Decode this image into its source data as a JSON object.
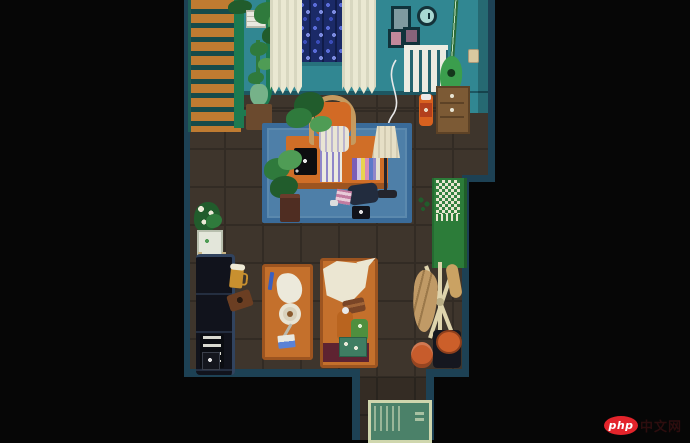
{
  "watermark": {
    "brand": "php",
    "suffix": "中文网"
  },
  "palette": {
    "bg": "#060606",
    "wall": "#318792",
    "wall_border": "#1d4154",
    "floor": "#3e352c",
    "floor_line": "#322b24",
    "rug": "#4e7fa8",
    "rug_border": "#3a6b99",
    "desk": "#d06e27",
    "desk_edge": "#9c5420",
    "table": "#c4702c",
    "table_edge": "#9c5420",
    "stairs_step": "#bf7b31",
    "stairs_gap": "#174b4a",
    "stairs_rail": "#1d7a50",
    "curtain": "#eae8d2",
    "window": "#1b2a67",
    "wisteria": "#5a6cd8",
    "plant": "#2f7a3c",
    "plant_dark": "#215c2c",
    "plant_light": "#4f9c55",
    "pot": "#4f2d22",
    "couch": "#11131c",
    "couch_edge": "#31435e",
    "wardrobe": "#2c7c39",
    "towel": "#e9e6d0",
    "towel_check": "#33803f",
    "mat": "#4b8169",
    "mat_border": "#cfd6ad",
    "radiator": "#ecece2",
    "lamp_shade": "#e6dfc6",
    "crate": "#7c5a35",
    "coat_rack": "#ded3ac",
    "coat": "#c09a66",
    "stool_top": "#cc5f2a",
    "pouf": "#c75c2c",
    "clock_face": "#a8d8d2",
    "guitar": "#3b9e4d",
    "maroon": "#5e2331",
    "blanket": "#ebe6d2",
    "cream": "#e9e9e0",
    "wm_red": "#e3242b",
    "wm_text": "#ffffff",
    "wm_suffix": "#2d0d0e"
  },
  "scene": {
    "objects": [
      "staircase",
      "banister-arch",
      "hanging-plant",
      "shelf-box",
      "tall-plant",
      "window",
      "curtain-left",
      "curtain-right",
      "picture-frames",
      "wall-clock",
      "radiator",
      "guitar",
      "light-switch",
      "storage-crate",
      "sauce-jar",
      "lamp-cord",
      "area-rug",
      "desk",
      "laptop",
      "notebook",
      "book-row",
      "desk-chair",
      "chair-plant",
      "floor-lamp",
      "rug-plant",
      "under-desk-bag",
      "camera",
      "pink-box",
      "flower-stand",
      "sofa",
      "console-stack",
      "beer-mug",
      "camera-case",
      "coffee-table",
      "pen",
      "napkin",
      "plate",
      "knife",
      "postcard",
      "bench",
      "blanket",
      "wallet",
      "bottle",
      "can",
      "snack-box",
      "wardrobe",
      "towel",
      "coat-rack",
      "coat",
      "pouf",
      "stool",
      "welcome-mat"
    ]
  }
}
